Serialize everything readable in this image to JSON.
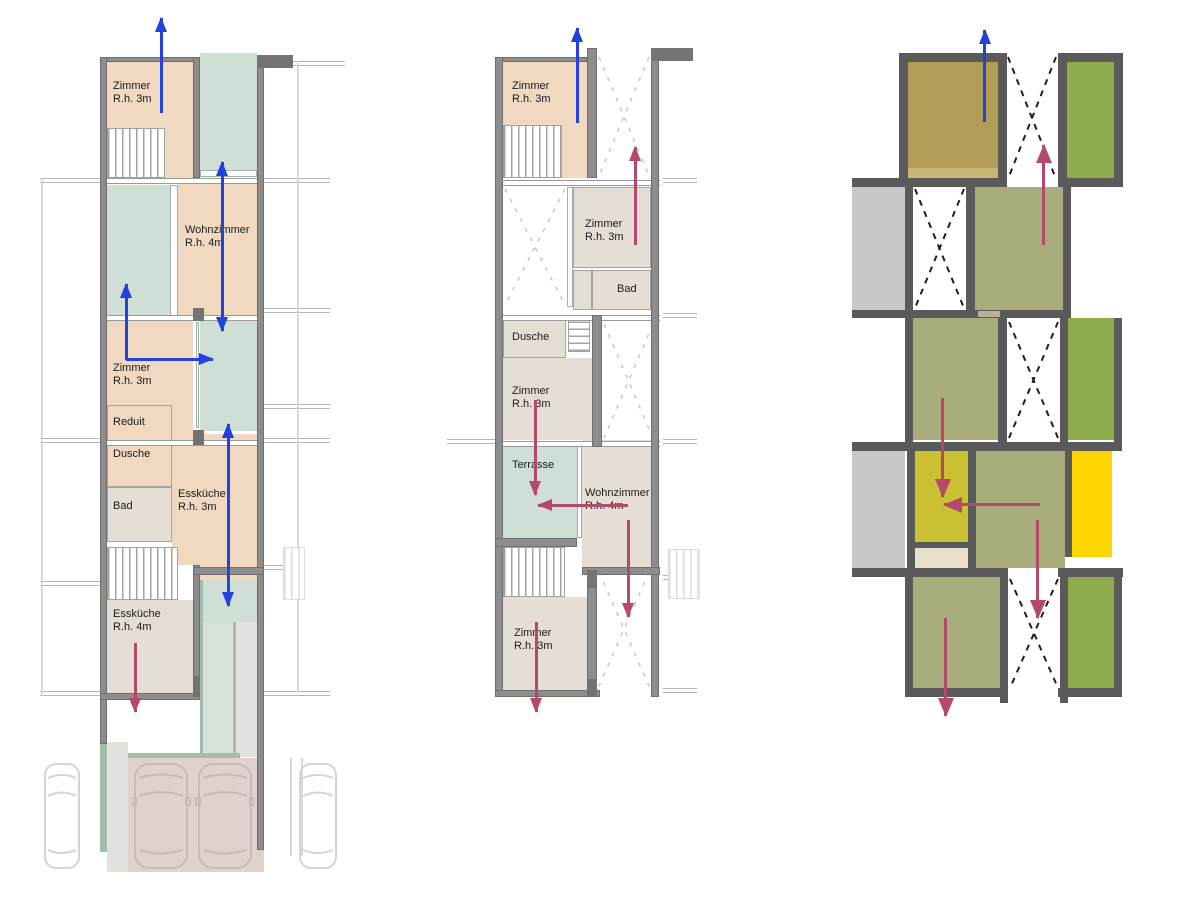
{
  "document": {
    "type": "architectural-section-drawing",
    "sections_count": 3
  },
  "labels": {
    "p1_zimmer_top": {
      "name": "Zimmer",
      "height": "R.h. 3m"
    },
    "p1_wohnzimmer": {
      "name": "Wohnzimmer",
      "height": "R.h. 4m"
    },
    "p1_zimmer_mid": {
      "name": "Zimmer",
      "height": "R.h. 3m"
    },
    "p1_reduit": {
      "name": "Reduit"
    },
    "p1_dusche": {
      "name": "Dusche"
    },
    "p1_bad": {
      "name": "Bad"
    },
    "p1_esskueche_3m": {
      "name": "Essküche",
      "height": "R.h. 3m"
    },
    "p1_esskueche_4m": {
      "name": "Essküche",
      "height": "R.h. 4m"
    },
    "p2_zimmer_top": {
      "name": "Zimmer",
      "height": "R.h. 3m"
    },
    "p2_zimmer_f4": {
      "name": "Zimmer",
      "height": "R.h. 3m"
    },
    "p2_bad": {
      "name": "Bad"
    },
    "p2_dusche": {
      "name": "Dusche"
    },
    "p2_zimmer_f3": {
      "name": "Zimmer",
      "height": "R.h. 3m"
    },
    "p2_terrasse": {
      "name": "Terrasse"
    },
    "p2_wohnzimmer": {
      "name": "Wohnzimmer",
      "height": "R.h. 4m"
    },
    "p2_zimmer_f1": {
      "name": "Zimmer",
      "height": "R.h. 3m"
    }
  },
  "colors": {
    "wall": "#8d8d8d",
    "wall_dark": "#6f6f6f",
    "wall_cap": "#737373",
    "wall3": "#5a5a5a",
    "line": "#9a9a9a",
    "text": "#1b1b1b",
    "peach": "#f0d8c1",
    "beige": "#e5ded4",
    "teal": "#cfdfd6",
    "teal_light": "#d6e2d8",
    "sage": "#a3bdac",
    "gray_strip": "#e1e1de",
    "mauve": "#dfd1cb",
    "car_line": "#c7bab8",
    "faint": "#d8d3ce",
    "olive_tan": "#b29d57",
    "olive": "#a9ad7b",
    "green": "#8dac4c",
    "chartreuse": "#cbc233",
    "yellow": "#fed500",
    "gray_block": "#c8c8c8",
    "beige_block": "#e8e0ca",
    "blue": "#2341dd",
    "red": "#b44a6b",
    "dash_light": "#ccc5b8",
    "dash_dark": "#1f1f1f"
  }
}
